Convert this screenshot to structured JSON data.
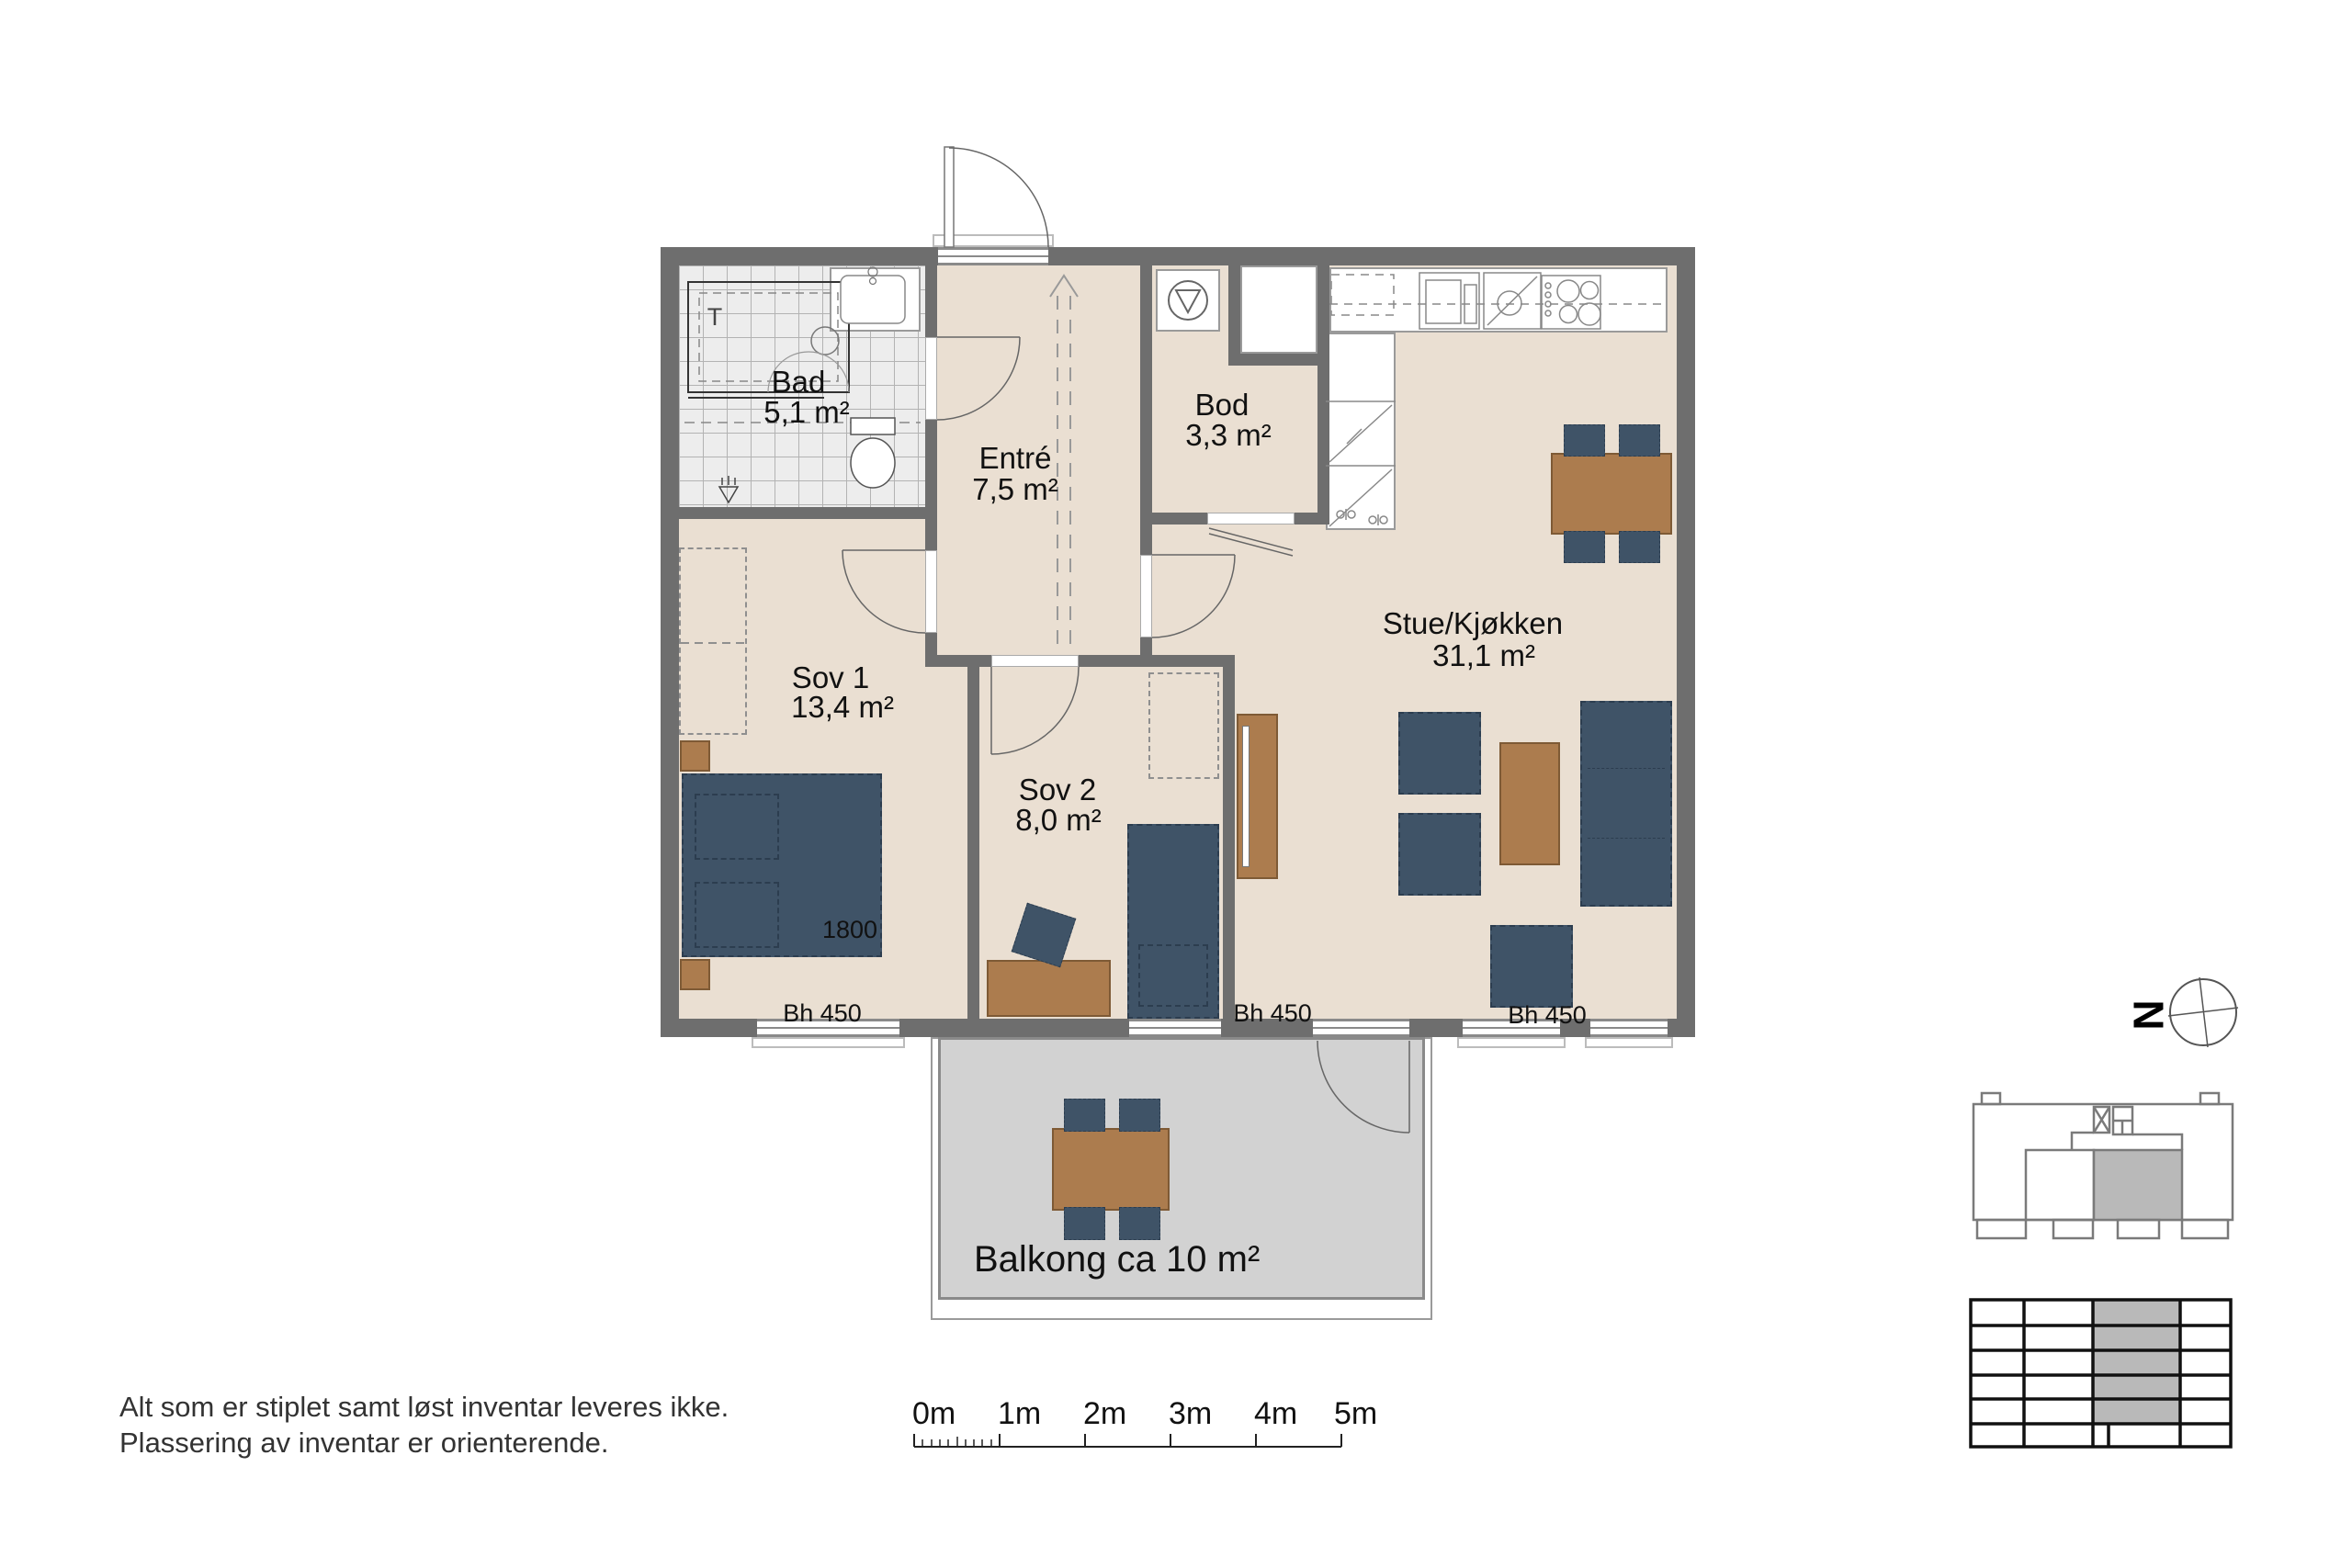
{
  "plan": {
    "rooms": [
      {
        "name": "Bad",
        "area": "5,1 m²"
      },
      {
        "name": "Entré",
        "area": "7,5 m²"
      },
      {
        "name": "Bod",
        "area": "3,3 m²"
      },
      {
        "name": "Sov 1",
        "area": "13,4 m²"
      },
      {
        "name": "Sov 2",
        "area": "8,0 m²"
      },
      {
        "name": "Stue/Kjøkken",
        "area": "31,1 m²"
      }
    ],
    "balcony_label": "Balkong ca 10 m²",
    "bed_width_mm": "1800",
    "sill_height_labels": [
      "Bh 450",
      "Bh 450",
      "Bh 450"
    ],
    "shower_mixer_label": "T"
  },
  "compass": {
    "north_label": "N"
  },
  "scale_bar": {
    "labels": [
      "0m",
      "1m",
      "2m",
      "3m",
      "4m",
      "5m"
    ]
  },
  "disclaimer": {
    "line1": "Alt som er stiplet samt løst inventar leveres ikke.",
    "line2": "Plassering av inventar er orienterende."
  },
  "colors": {
    "wall": "#6e6e6e",
    "floor": "#eadfd2",
    "tile_floor": "#ededed",
    "furniture_blue": "#3f5367",
    "furniture_wood": "#ac7c4e",
    "balcony_floor": "#d2d2d2",
    "unit_highlight": "#b9b9b9"
  }
}
